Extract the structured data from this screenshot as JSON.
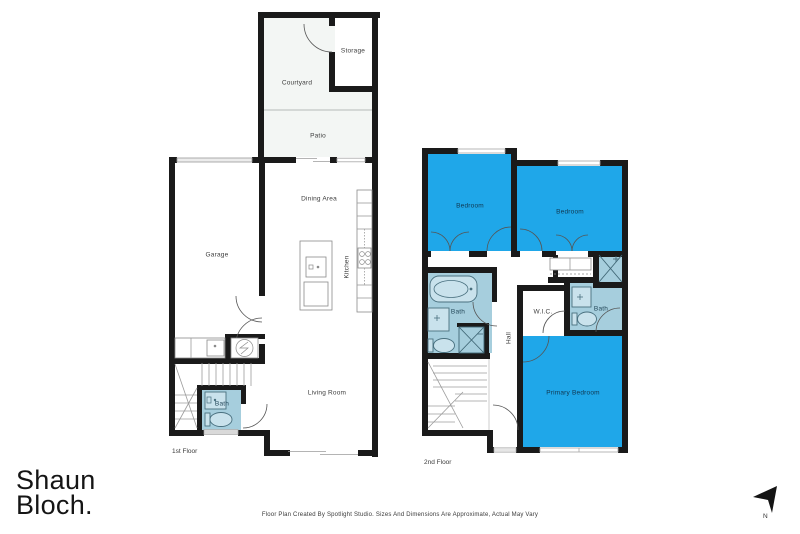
{
  "branding": {
    "logo_line1": "Shaun",
    "logo_line2": "Bloch."
  },
  "footer": {
    "disclaimer": "Floor Plan Created By Spotlight Studio. Sizes And Dimensions Are Approximate, Actual May Vary"
  },
  "compass": {
    "label": "N"
  },
  "colors": {
    "wall": "#1a1a1a",
    "bedroom_fill": "#1FA7E9",
    "bath_fill": "#A6CEDD",
    "outdoor_fill": "#F3F6F4",
    "label_on_blue": "#10364F",
    "label_default": "#3d3d3d"
  },
  "floor1": {
    "name": "1st Floor",
    "rooms": {
      "storage": "Storage",
      "courtyard": "Courtyard",
      "patio": "Patio",
      "dining": "Dining Area",
      "garage": "Garage",
      "kitchen": "Kitchen",
      "living": "Living Room",
      "bath": "Bath"
    }
  },
  "floor2": {
    "name": "2nd Floor",
    "rooms": {
      "bedroom1": "Bedroom",
      "bedroom2": "Bedroom",
      "bath1": "Bath",
      "hall": "Hall",
      "wic": "W.I.C.",
      "bath2": "Bath",
      "primary": "Primary Bedroom"
    }
  }
}
